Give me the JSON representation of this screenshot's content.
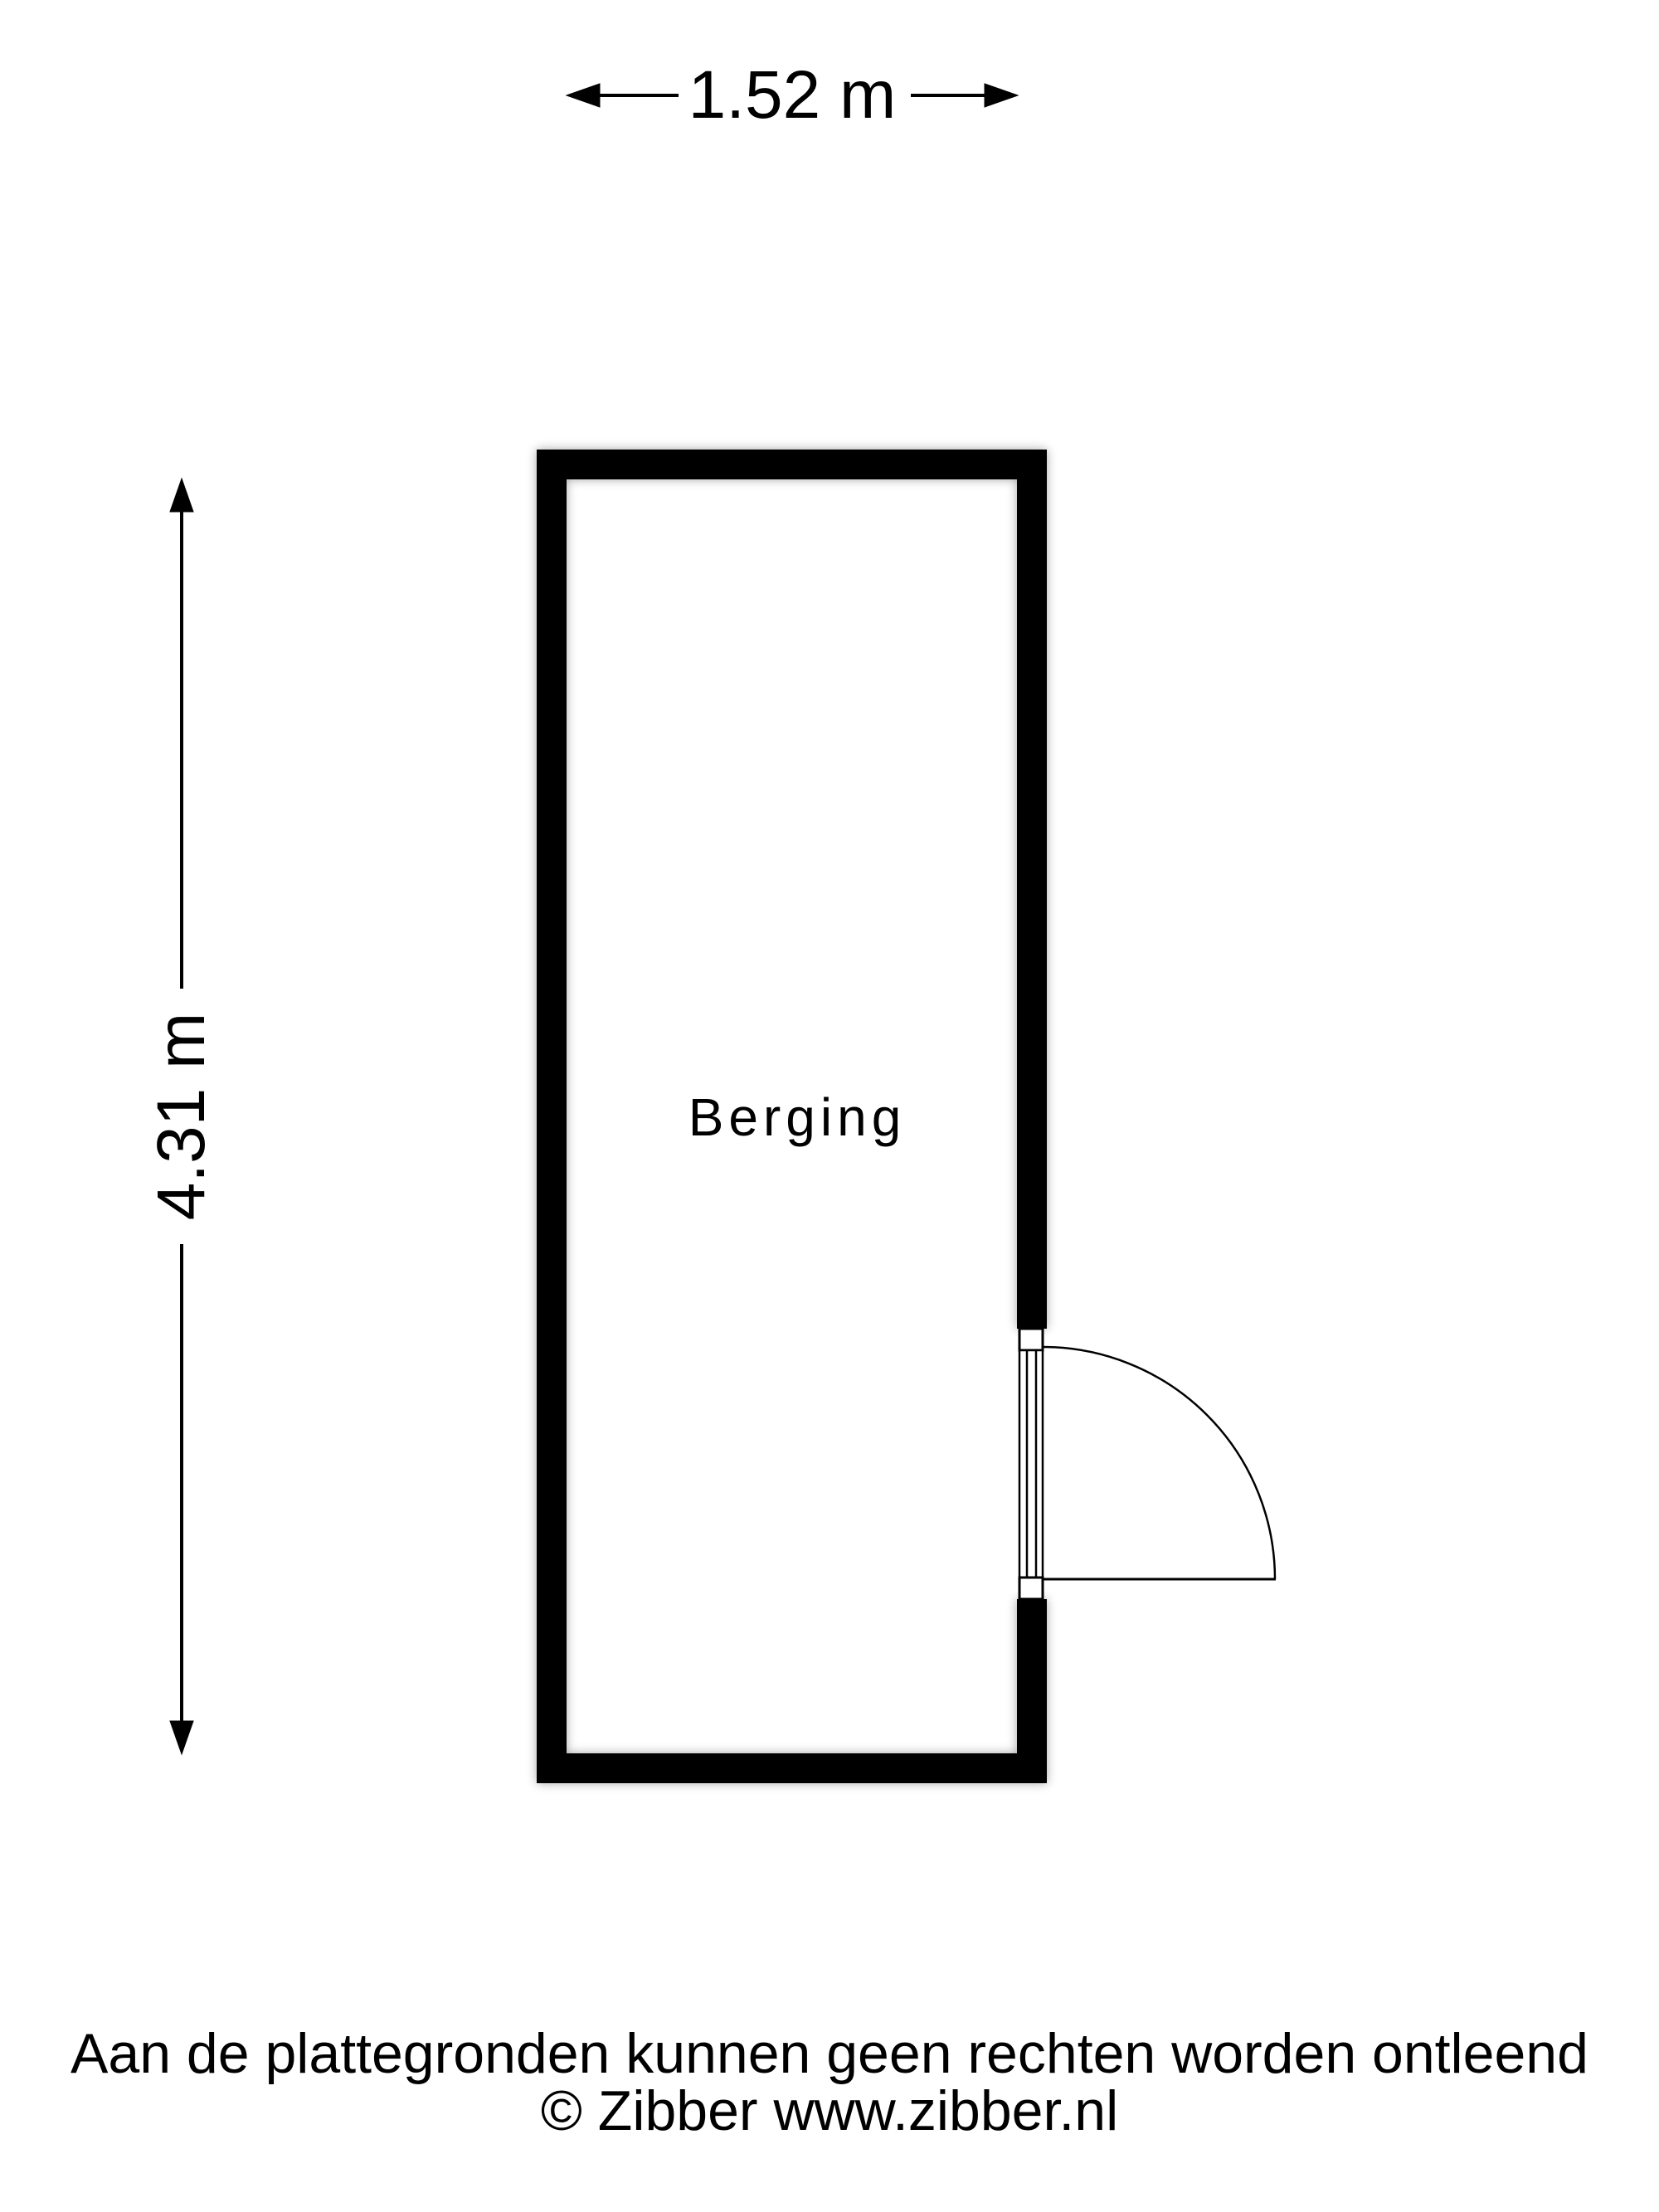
{
  "floorplan": {
    "room": {
      "label": "Berging"
    },
    "dimensions": {
      "width": {
        "label": "1.52 m"
      },
      "height": {
        "label": "4.31 m"
      }
    },
    "colors": {
      "wall": "#000000",
      "line": "#000000",
      "background": "#ffffff"
    }
  },
  "footer": {
    "disclaimer": "Aan de plattegronden kunnen geen rechten worden ontleend",
    "copyright": "© Zibber www.zibber.nl"
  }
}
